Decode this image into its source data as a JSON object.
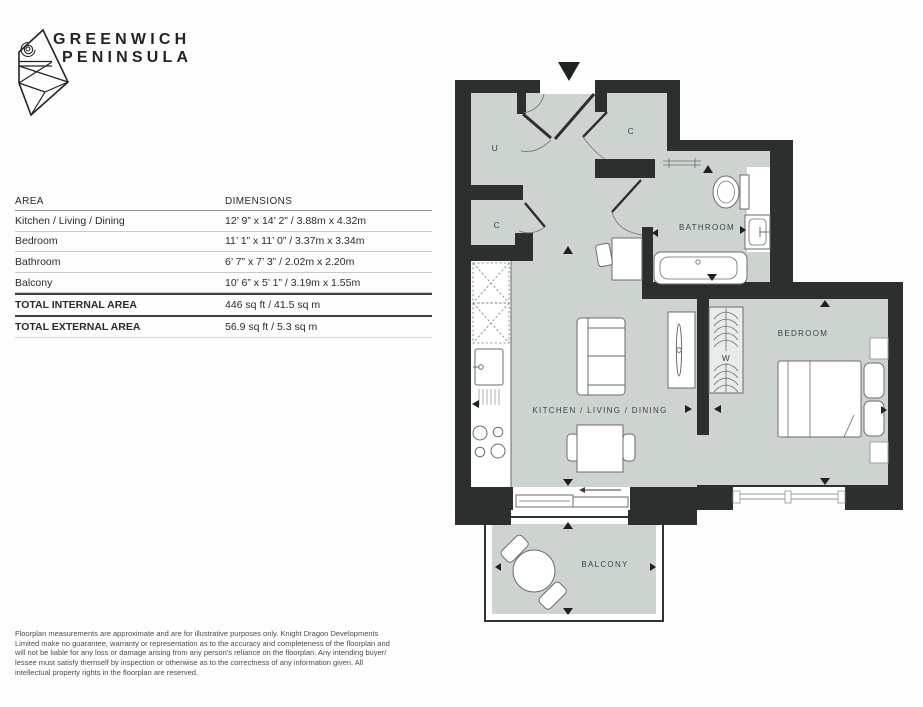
{
  "brand": {
    "line1": "GREENWICH",
    "line2": "PENINSULA"
  },
  "area_table": {
    "headers": {
      "area": "AREA",
      "dimensions": "DIMENSIONS"
    },
    "rows": [
      {
        "area": "Kitchen / Living / Dining",
        "dimensions": "12’ 9” x 14’ 2” / 3.88m x 4.32m"
      },
      {
        "area": "Bedroom",
        "dimensions": "11’ 1” x 11’ 0” / 3.37m x 3.34m"
      },
      {
        "area": "Bathroom",
        "dimensions": "6’ 7” x 7’ 3” / 2.02m x 2.20m"
      },
      {
        "area": "Balcony",
        "dimensions": "10’ 6” x 5’ 1” / 3.19m x 1.55m"
      }
    ],
    "totals": [
      {
        "area": "TOTAL INTERNAL AREA",
        "dimensions": "446 sq ft / 41.5 sq m"
      },
      {
        "area": "TOTAL EXTERNAL AREA",
        "dimensions": "56.9 sq ft / 5.3 sq m"
      }
    ]
  },
  "floorplan": {
    "labels": {
      "kitchen_living_dining": "KITCHEN / LIVING / DINING",
      "bedroom": "BEDROOM",
      "bathroom": "BATHROOM",
      "balcony": "BALCONY",
      "wardrobe": "W",
      "utility_cupboard": "U",
      "closet_top": "C",
      "closet_left": "C"
    },
    "colors": {
      "wall": "#2b302e",
      "floor": "#cdd4d0",
      "outline": "#676d6a"
    }
  },
  "disclaimer": "Floorplan measurements are approximate and are for illustrative purposes only. Knight Dragon Developments Limited make no guarantee, warranty or representation as to the accuracy and completeness of the floorplan and will not be liable for any loss or damage arising from any person’s reliance on the floorplan. Any intending buyer/ lessee must satisfy themself by inspection or otherwise as to the correctness of any information given. All intellectual property rights in the floorplan are reserved."
}
